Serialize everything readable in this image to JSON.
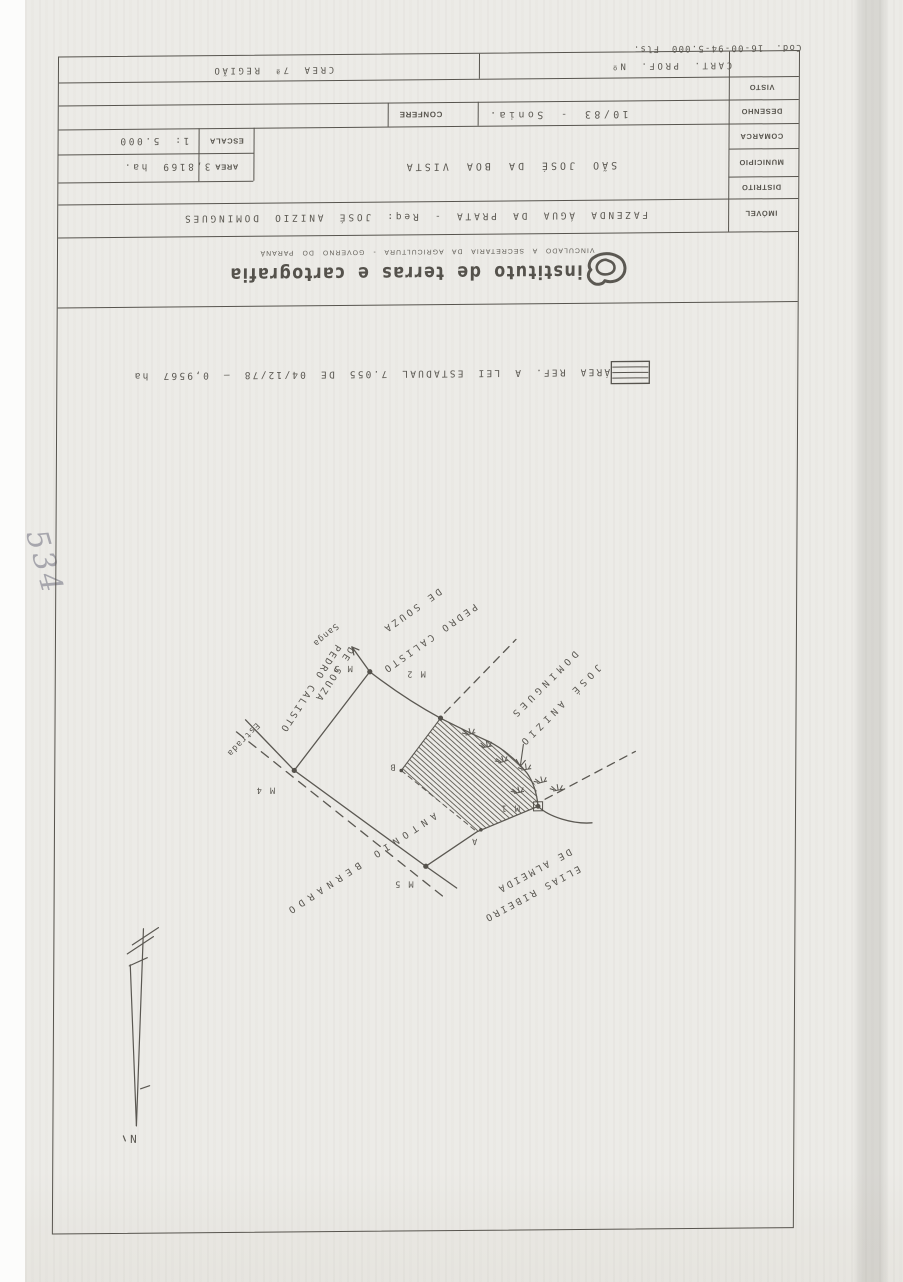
{
  "page": {
    "handwritten_number": "534"
  },
  "title_block": {
    "cod_line": "Cod. 16-00-94-5.000 Fls.",
    "row1": {
      "cart_prof": "CART. PROF. Nº",
      "crea": "CREA 7ª REGIÃO"
    },
    "labels": {
      "visto": "VISTO",
      "desenho": "DESENHO",
      "comarca": "COMARCA",
      "municipio": "MUNICIPIO",
      "distrito": "DISTRITO",
      "imovel": "IMÓVEL"
    },
    "values": {
      "desenho": "10/83 - Sonia.",
      "confere": "CONFERE",
      "municipio": "SÃO JOSÉ DA BOA VISTA",
      "escala_label": "ESCALA",
      "escala": "1: 5.000",
      "area_label": "AREA",
      "area": "3,8169 ha.",
      "imovel": "FAZENDA ÁGUA DA PRATA - Req: JOSÉ ANIZIO DOMINGUES"
    }
  },
  "letterhead": {
    "name": "instituto de terras e cartografia",
    "subtitle": "VINCULADO A SECRETARIA DA AGRICULTURA - GOVERNO DO PARANÁ"
  },
  "legend": {
    "text": "ÁREA REF. A LEI ESTADUAL 7.055 DE 04/12/78 — 0,9567 ha"
  },
  "map": {
    "north_label": "N",
    "markers": {
      "m1": "M 1",
      "m2": "M 2",
      "m3": "M 3",
      "m4": "M 4",
      "m5": "M 5",
      "a": "A",
      "b": "B"
    },
    "features": {
      "estrada": "Estrada",
      "sanga": "Sanga"
    },
    "neighbors": {
      "pedro_upper_1": "PEDRO CALISTO",
      "pedro_upper_2": "DE SOUZA",
      "pedro_left_1": "PEDRO CALISTO",
      "pedro_left_2": "DE SOUZA",
      "jose_1": "JOSÉ ANIZIO",
      "jose_2": "DOMINGUES",
      "antonio": "ANTONIO BERNARDO",
      "elias_1": "ELIAS RIBEIRO",
      "elias_2": "DE ALMEIDA"
    }
  },
  "colors": {
    "ink": "#5b5852",
    "line": "#57544e",
    "paper": "#ecebe7",
    "pencil": "#90909a"
  }
}
